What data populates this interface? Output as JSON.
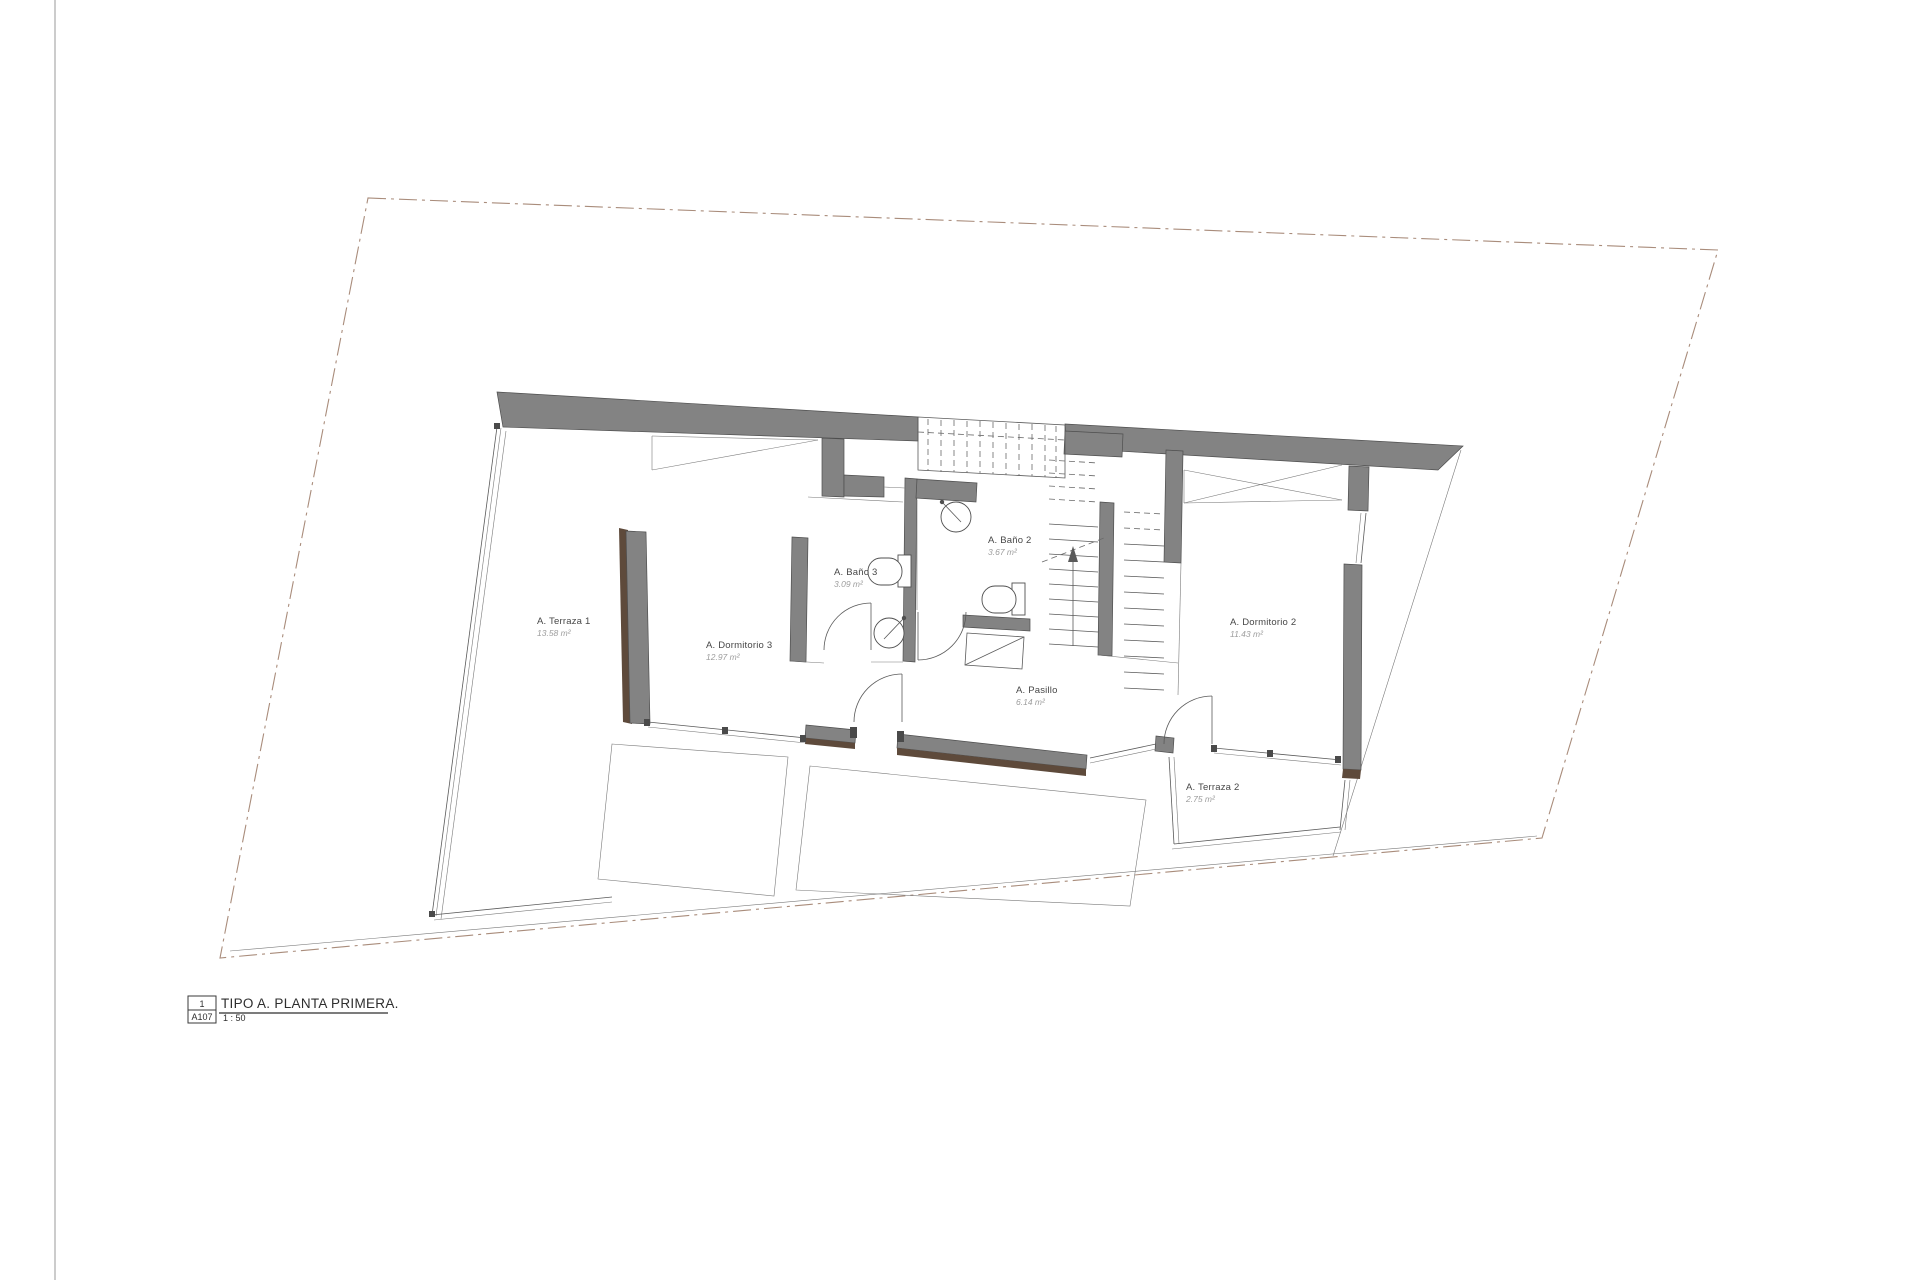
{
  "drawing": {
    "rooms": [
      {
        "name": "A. Terraza 1",
        "area": "13.58 m²"
      },
      {
        "name": "A. Dormitorio 3",
        "area": "12.97 m²"
      },
      {
        "name": "A. Baño 3",
        "area": "3.09 m²"
      },
      {
        "name": "A. Baño 2",
        "area": "3.67 m²"
      },
      {
        "name": "A. Pasillo",
        "area": "6.14 m²"
      },
      {
        "name": "A. Dormitorio 2",
        "area": "11.43 m²"
      },
      {
        "name": "A. Terraza 2",
        "area": "2.75 m²"
      }
    ],
    "title_block": {
      "detail_number": "1",
      "sheet": "A107",
      "title": "TIPO A. PLANTA PRIMERA.",
      "scale": "1 : 50"
    },
    "colors": {
      "wall": "#838383",
      "wood_accent": "#5e4a3b",
      "plot_boundary": "#a98c7b",
      "line": "#5a5a5a"
    }
  }
}
